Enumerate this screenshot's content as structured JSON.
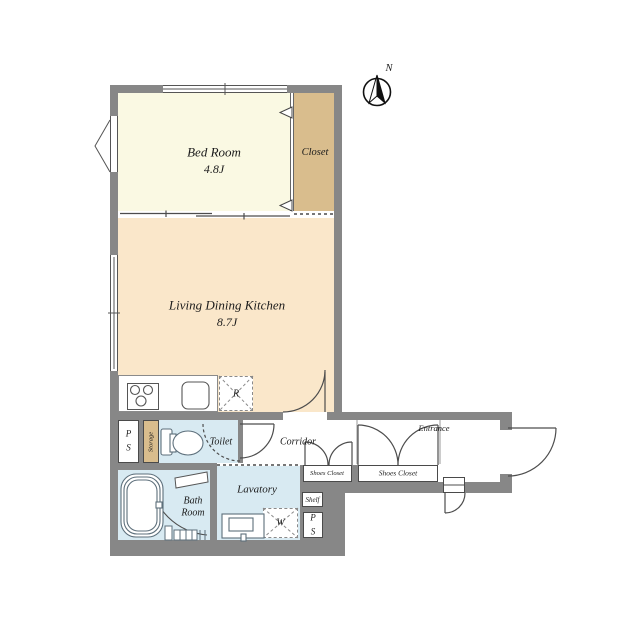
{
  "plan": {
    "compass_label": "N",
    "rooms": {
      "bedroom": {
        "name": "Bed Room",
        "size": "4.8J"
      },
      "closet": {
        "name": "Closet"
      },
      "ldk": {
        "name": "Living Dining Kitchen",
        "size": "8.7J"
      },
      "toilet": {
        "name": "Toilet"
      },
      "corridor": {
        "name": "Corridor"
      },
      "entrance": {
        "name": "Entrance"
      },
      "shoes_closet_a": {
        "name": "Shoes Closet"
      },
      "shoes_closet_b": {
        "name": "Shoes Closet"
      },
      "bath": {
        "name": "Bath Room"
      },
      "lavatory": {
        "name": "Lavatory"
      },
      "storage": {
        "name": "Storage"
      },
      "shelf": {
        "name": "Shelf"
      }
    },
    "fixtures": {
      "pipe_space_upper": "P S",
      "pipe_space_lower": "P S",
      "refrigerator_space": "R",
      "washer_space": "W"
    },
    "colors": {
      "wall": "#878787",
      "bedroom_fill": "#faf9e3",
      "closet_fill": "#d9bd8d",
      "ldk_fill": "#fae7ca",
      "wet_area_fill": "#d8eaf2",
      "line": "#4d4d4d"
    }
  }
}
